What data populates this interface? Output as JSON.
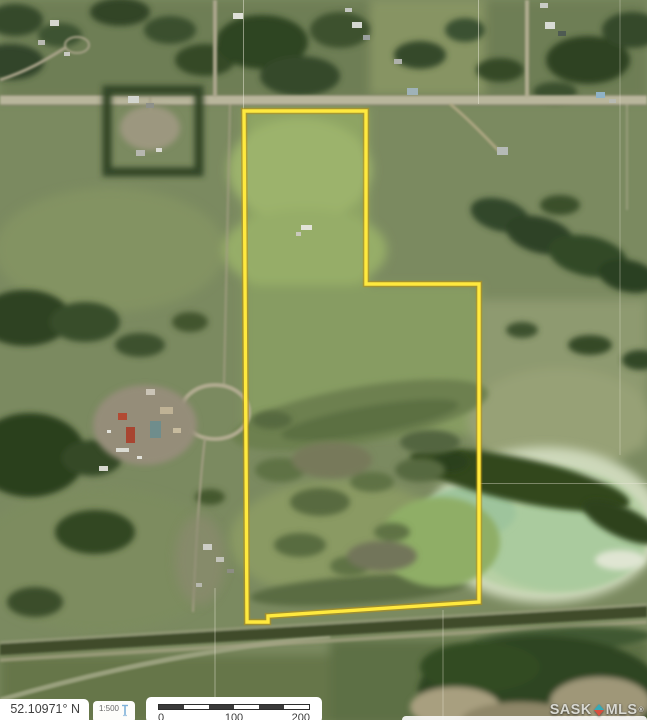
{
  "map_view": {
    "boundary": {
      "color": "#FFE93E",
      "outline_color": "#BA920F",
      "points": "244,111 366,111 366,284 479,284 479,602 268,616 268,622 247,622"
    },
    "watermark": {
      "brand_left": "SASK",
      "brand_right": "MLS",
      "registered": "®",
      "pin_top_color": "#35AAB8",
      "pin_bottom_color": "#D94F3F"
    }
  },
  "hud": {
    "coordinate_readout": "52.10971° N",
    "scale_ratio": "1:500",
    "scale_bar_ticks": [
      "0",
      "100",
      "200"
    ]
  }
}
